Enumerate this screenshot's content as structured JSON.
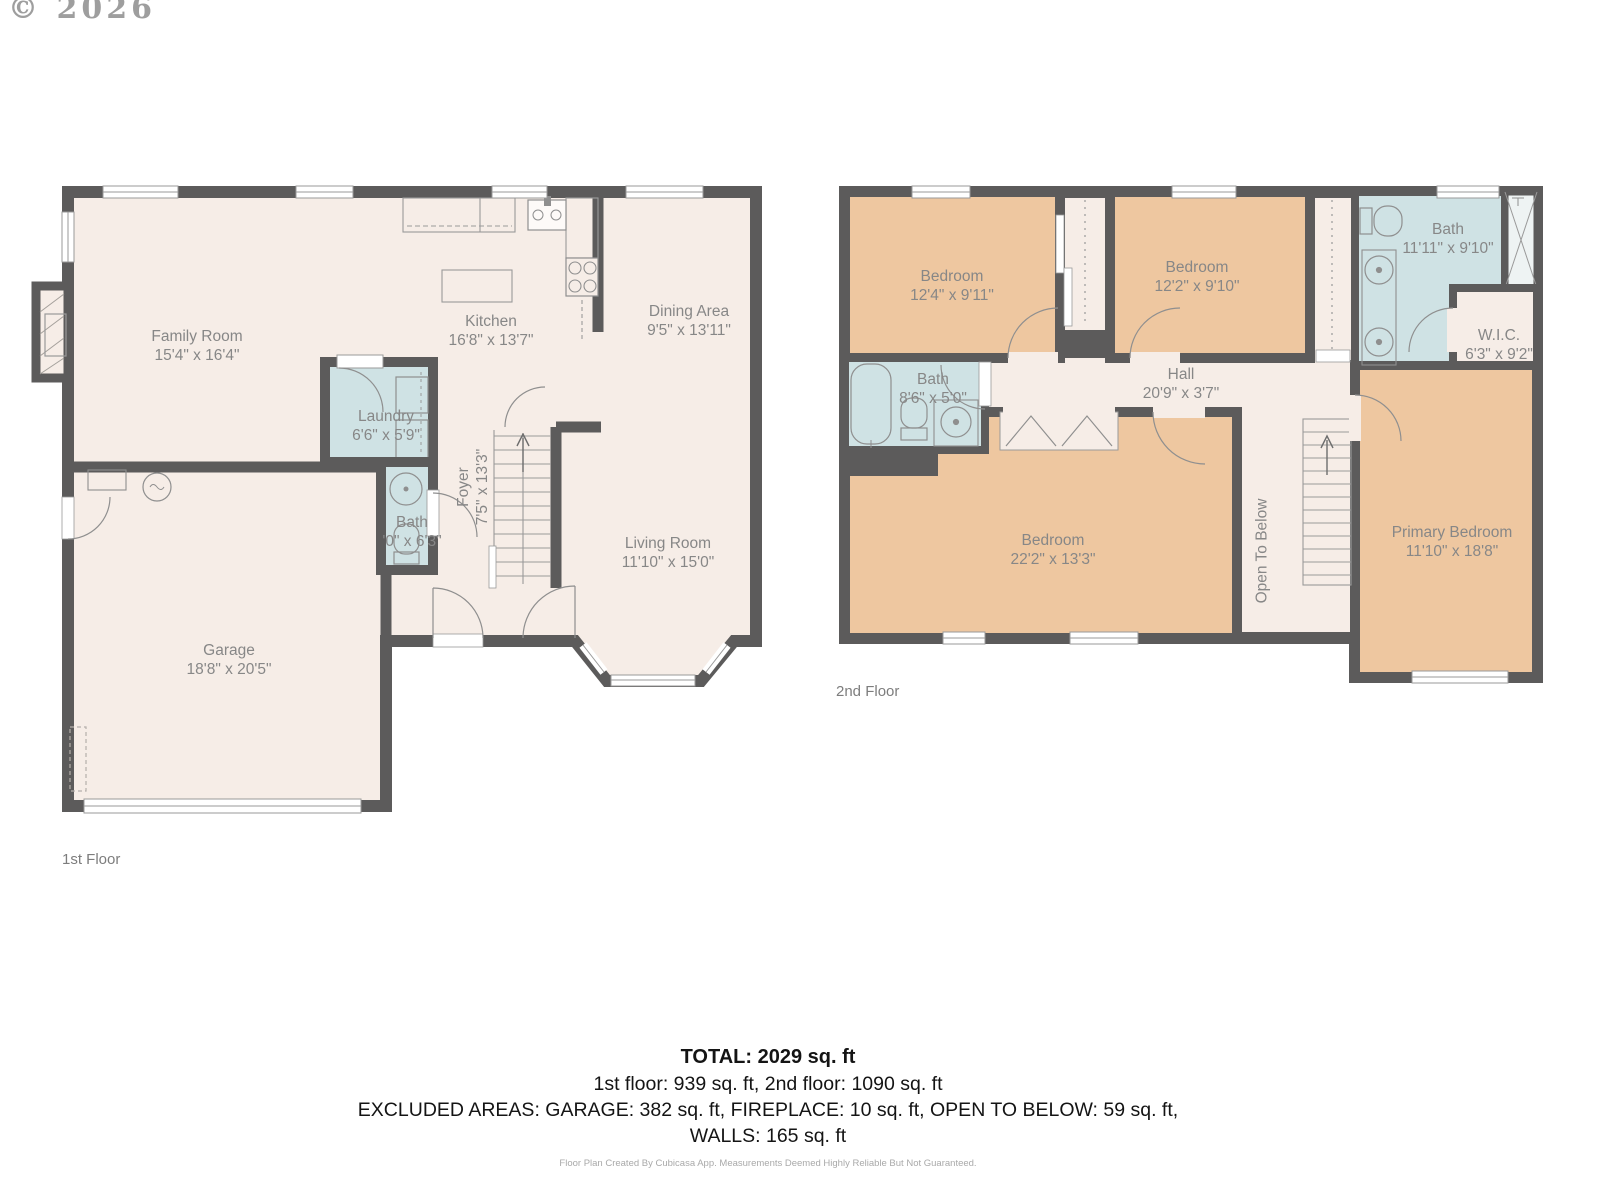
{
  "copyright": "© 2026",
  "colors": {
    "wall": "#5c5b5b",
    "room_default": "#f6ede7",
    "room_bedroom": "#eec7a0",
    "room_wet": "#cfe2e4",
    "label_text": "#878787"
  },
  "floors": {
    "first": {
      "label": "1st Floor",
      "rooms": {
        "family_room": {
          "name": "Family Room",
          "dims": "15'4\" x 16'4\""
        },
        "kitchen": {
          "name": "Kitchen",
          "dims": "16'8\" x 13'7\""
        },
        "dining_area": {
          "name": "Dining Area",
          "dims": "9'5\" x 13'11\""
        },
        "laundry": {
          "name": "Laundry",
          "dims": "6'6\" x 5'9\""
        },
        "bath": {
          "name": "Bath",
          "dims": "'0\" x 6'3\""
        },
        "foyer": {
          "name": "Foyer",
          "dims": "7'5\" x 13'3\""
        },
        "living_room": {
          "name": "Living Room",
          "dims": "11'10\" x 15'0\""
        },
        "garage": {
          "name": "Garage",
          "dims": "18'8\" x 20'5\""
        }
      }
    },
    "second": {
      "label": "2nd Floor",
      "rooms": {
        "bedroom_1": {
          "name": "Bedroom",
          "dims": "12'4\" x 9'11\""
        },
        "bedroom_2": {
          "name": "Bedroom",
          "dims": "12'2\" x 9'10\""
        },
        "bath_main": {
          "name": "Bath",
          "dims": "11'11\" x 9'10\""
        },
        "wic": {
          "name": "W.I.C.",
          "dims": "6'3\" x 9'2\""
        },
        "bath_hall": {
          "name": "Bath",
          "dims": "8'6\" x 5'0\""
        },
        "hall": {
          "name": "Hall",
          "dims": "20'9\" x 3'7\""
        },
        "bedroom_3": {
          "name": "Bedroom",
          "dims": "22'2\" x 13'3\""
        },
        "open_to_below": {
          "name": "Open To Below"
        },
        "primary_bedroom": {
          "name": "Primary Bedroom",
          "dims": "11'10\" x 18'8\""
        }
      }
    }
  },
  "summary": {
    "total": "TOTAL: 2029 sq. ft",
    "floors_line": "1st floor: 939 sq. ft, 2nd floor: 1090 sq. ft",
    "excluded_line": "EXCLUDED AREAS: GARAGE: 382 sq. ft, FIREPLACE: 10 sq. ft, OPEN TO BELOW: 59 sq. ft,",
    "walls_line": "WALLS: 165 sq. ft",
    "disclaimer": "Floor Plan Created By Cubicasa App. Measurements Deemed Highly Reliable But Not Guaranteed."
  }
}
